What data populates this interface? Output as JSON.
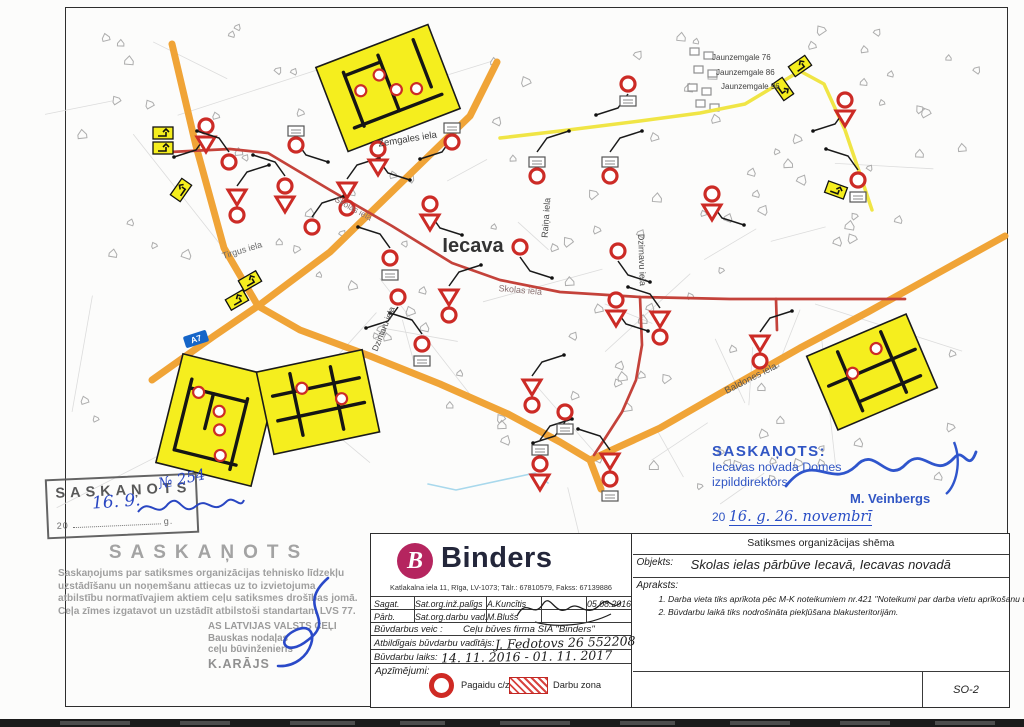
{
  "map": {
    "town_label": "Iecava",
    "route_shield": "A7",
    "colors": {
      "road_primary": "#F0A437",
      "detour_yellow": "#F0E545",
      "construction_red": "#C4423A",
      "sign_red": "#CC2B26",
      "inset_yellow": "#F5EE1E",
      "shield_blue": "#1565C8",
      "stamp_blue": "#3156C4",
      "ink_blue": "#2946C2",
      "stamp_gray": "#999999",
      "building_gray": "#ADADAD",
      "parcel_gray": "#DCDCDC",
      "stream_blue": "#A8D8EC"
    },
    "street_labels": [
      {
        "text": "Zemgales iela",
        "x": 408,
        "y": 142,
        "rot": -9,
        "size": 9.5,
        "color": "#3a3a3a"
      },
      {
        "text": "Tirgus iela",
        "x": 243,
        "y": 253,
        "rot": -17,
        "size": 9,
        "color": "#6b6b6b"
      },
      {
        "text": "Raiņa iela",
        "x": 549,
        "y": 218,
        "rot": -86,
        "size": 9,
        "color": "#4a4a4a"
      },
      {
        "text": "Dzirnavu iela",
        "x": 639,
        "y": 260,
        "rot": 88,
        "size": 9,
        "color": "#4a4a4a"
      },
      {
        "text": "Dzintaru iela",
        "x": 386,
        "y": 330,
        "rot": -68,
        "size": 8.5,
        "color": "#4a4a4a"
      },
      {
        "text": "Skolas iela",
        "x": 520,
        "y": 293,
        "rot": 5,
        "size": 9,
        "color": "#8a7272"
      },
      {
        "text": "Skolas iela",
        "x": 352,
        "y": 211,
        "rot": 29,
        "size": 8.5,
        "color": "#8a7272"
      },
      {
        "text": "Baldones iela",
        "x": 752,
        "y": 381,
        "rot": -27,
        "size": 9.5,
        "color": "#555555"
      }
    ],
    "address_labels": [
      {
        "text": "Jaunzemgale 76",
        "x": 712,
        "y": 60
      },
      {
        "text": "Jaunzemgale 86",
        "x": 716,
        "y": 75
      },
      {
        "text": "Jaunzemgale 96",
        "x": 721,
        "y": 89
      }
    ],
    "roads": [
      {
        "name": "regional-road-north",
        "kind": "primary",
        "w": 7,
        "pts": [
          [
            172,
            44
          ],
          [
            196,
            146
          ],
          [
            224,
            248
          ],
          [
            258,
            306
          ]
        ]
      },
      {
        "name": "a7-zemgales-diagonal",
        "kind": "primary",
        "w": 7,
        "pts": [
          [
            152,
            380
          ],
          [
            214,
            336
          ],
          [
            258,
            306
          ],
          [
            330,
            252
          ],
          [
            404,
            180
          ],
          [
            470,
            116
          ],
          [
            497,
            62
          ]
        ]
      },
      {
        "name": "road-to-south-junction",
        "kind": "primary",
        "w": 7,
        "pts": [
          [
            258,
            306
          ],
          [
            300,
            330
          ],
          [
            370,
            356
          ],
          [
            440,
            384
          ],
          [
            508,
            414
          ],
          [
            560,
            442
          ],
          [
            590,
            460
          ],
          [
            601,
            489
          ]
        ]
      },
      {
        "name": "baldones-diagonal",
        "kind": "primary",
        "w": 7,
        "pts": [
          [
            590,
            460
          ],
          [
            660,
            428
          ],
          [
            726,
            390
          ],
          [
            800,
            348
          ],
          [
            868,
            312
          ],
          [
            940,
            272
          ],
          [
            1005,
            236
          ]
        ]
      },
      {
        "name": "detour-route",
        "kind": "detour",
        "w": 3.5,
        "pts": [
          [
            500,
            138
          ],
          [
            560,
            131
          ],
          [
            640,
            121
          ],
          [
            700,
            113
          ],
          [
            745,
            104
          ],
          [
            800,
            71
          ],
          [
            824,
            84
          ],
          [
            845,
            130
          ],
          [
            862,
            180
          ],
          [
            872,
            210
          ]
        ]
      },
      {
        "name": "skolas-iela-construction",
        "kind": "construction",
        "w": 2.7,
        "pts": [
          [
            170,
            152
          ],
          [
            230,
            149
          ],
          [
            268,
            153
          ],
          [
            330,
            190
          ],
          [
            392,
            226
          ],
          [
            452,
            263
          ],
          [
            500,
            280
          ],
          [
            560,
            292
          ],
          [
            640,
            297
          ],
          [
            730,
            299
          ],
          [
            905,
            299
          ]
        ]
      },
      {
        "name": "construction-branch-south",
        "kind": "construction",
        "w": 2.7,
        "pts": [
          [
            640,
            297
          ],
          [
            642,
            345
          ],
          [
            636,
            380
          ],
          [
            622,
            412
          ],
          [
            604,
            440
          ],
          [
            594,
            455
          ]
        ]
      },
      {
        "name": "construction-stub",
        "kind": "construction",
        "w": 2.7,
        "pts": [
          [
            776,
            299
          ],
          [
            777,
            330
          ]
        ]
      },
      {
        "name": "stream",
        "kind": "stream",
        "w": 1.6,
        "pts": [
          [
            428,
            484
          ],
          [
            456,
            490
          ],
          [
            535,
            473
          ],
          [
            548,
            483
          ]
        ]
      }
    ],
    "shield": {
      "x": 196,
      "y": 339,
      "rot": -18
    },
    "signs": [
      {
        "x": 163,
        "y": 133,
        "t": [
          "yp",
          "yp"
        ]
      },
      {
        "x": 181,
        "y": 190,
        "t": [
          "yp"
        ],
        "r": -55
      },
      {
        "x": 206,
        "y": 126,
        "t": [
          "ring",
          "tri"
        ],
        "f": -1,
        "ly": 1
      },
      {
        "x": 229,
        "y": 162,
        "t": [
          "ring"
        ],
        "f": -1,
        "ly": -1
      },
      {
        "x": 237,
        "y": 196,
        "t": [
          "tri",
          "ring"
        ],
        "f": 1,
        "ly": -1
      },
      {
        "x": 285,
        "y": 186,
        "t": [
          "ring",
          "tri"
        ],
        "f": -1,
        "ly": -1
      },
      {
        "x": 296,
        "y": 131,
        "t": [
          "plate",
          "ring"
        ],
        "f": 1,
        "ly": 1
      },
      {
        "x": 312,
        "y": 227,
        "t": [
          "ring"
        ],
        "f": 1,
        "ly": -1
      },
      {
        "x": 347,
        "y": 189,
        "t": [
          "tri",
          "ring"
        ],
        "f": 1,
        "ly": -1
      },
      {
        "x": 378,
        "y": 149,
        "t": [
          "ring",
          "tri"
        ],
        "f": 1,
        "ly": 1
      },
      {
        "x": 390,
        "y": 258,
        "t": [
          "ring",
          "plate"
        ],
        "f": -1,
        "ly": -1
      },
      {
        "x": 430,
        "y": 204,
        "t": [
          "ring",
          "tri"
        ],
        "f": 1,
        "ly": 1
      },
      {
        "x": 398,
        "y": 297,
        "t": [
          "ring"
        ],
        "f": -1,
        "ly": 1
      },
      {
        "x": 422,
        "y": 344,
        "t": [
          "ring",
          "plate"
        ],
        "f": -1,
        "ly": -1
      },
      {
        "x": 452,
        "y": 128,
        "t": [
          "plate",
          "ring"
        ],
        "f": -1,
        "ly": 1
      },
      {
        "x": 449,
        "y": 296,
        "t": [
          "tri",
          "ring"
        ],
        "f": 1,
        "ly": -1
      },
      {
        "x": 537,
        "y": 162,
        "t": [
          "plate",
          "ring"
        ],
        "f": 1,
        "ly": -1
      },
      {
        "x": 610,
        "y": 162,
        "t": [
          "plate",
          "ring"
        ],
        "f": 1,
        "ly": -1
      },
      {
        "x": 520,
        "y": 247,
        "t": [
          "ring"
        ],
        "f": 1,
        "ly": 1
      },
      {
        "x": 532,
        "y": 386,
        "t": [
          "tri",
          "ring"
        ],
        "f": 1,
        "ly": -1
      },
      {
        "x": 618,
        "y": 251,
        "t": [
          "ring"
        ],
        "f": 1,
        "ly": 1
      },
      {
        "x": 616,
        "y": 300,
        "t": [
          "ring",
          "tri"
        ],
        "f": 1,
        "ly": 1
      },
      {
        "x": 660,
        "y": 318,
        "t": [
          "tri",
          "ring"
        ],
        "f": -1,
        "ly": -1
      },
      {
        "x": 712,
        "y": 194,
        "t": [
          "ring",
          "tri"
        ],
        "f": 1,
        "ly": 1
      },
      {
        "x": 760,
        "y": 342,
        "t": [
          "tri",
          "ring"
        ],
        "f": 1,
        "ly": -1
      },
      {
        "x": 628,
        "y": 84,
        "t": [
          "ring",
          "plate"
        ],
        "f": -1,
        "ly": 1
      },
      {
        "x": 845,
        "y": 100,
        "t": [
          "ring",
          "tri"
        ],
        "f": -1,
        "ly": 1
      },
      {
        "x": 858,
        "y": 180,
        "t": [
          "ring",
          "plate"
        ],
        "f": -1,
        "ly": -1
      },
      {
        "x": 836,
        "y": 190,
        "t": [
          "yp"
        ],
        "r": 20
      },
      {
        "x": 610,
        "y": 460,
        "t": [
          "tri",
          "ring",
          "plate"
        ],
        "f": -1,
        "ly": -1
      },
      {
        "x": 540,
        "y": 450,
        "t": [
          "plate",
          "ring",
          "tri"
        ],
        "f": 1,
        "ly": -1
      },
      {
        "x": 565,
        "y": 412,
        "t": [
          "ring",
          "plate"
        ],
        "f": -1,
        "ly": 1
      },
      {
        "x": 250,
        "y": 281,
        "t": [
          "yp"
        ],
        "r": -30
      },
      {
        "x": 237,
        "y": 300,
        "t": [
          "yp"
        ],
        "r": -30
      },
      {
        "x": 800,
        "y": 66,
        "t": [
          "yp"
        ],
        "r": -35
      },
      {
        "x": 783,
        "y": 89,
        "t": [
          "yp"
        ],
        "r": 55
      }
    ],
    "insets": [
      {
        "cx": 388,
        "cy": 88,
        "w": 120,
        "h": 90,
        "rot": -21,
        "circles": [
          [
            0.28,
            0.42
          ],
          [
            0.47,
            0.33
          ],
          [
            0.56,
            0.55
          ],
          [
            0.72,
            0.62
          ]
        ],
        "lines": [
          [
            0.12,
            0.78,
            0.9,
            0.78
          ],
          [
            0.2,
            0.16,
            0.2,
            0.8
          ],
          [
            0.52,
            0.12,
            0.52,
            0.78
          ],
          [
            0.84,
            0.1,
            0.84,
            0.66
          ],
          [
            0.2,
            0.2,
            0.52,
            0.2
          ]
        ]
      },
      {
        "cx": 217,
        "cy": 420,
        "w": 98,
        "h": 112,
        "rot": 14,
        "circles": [
          [
            0.25,
            0.3
          ],
          [
            0.5,
            0.42
          ],
          [
            0.55,
            0.58
          ],
          [
            0.62,
            0.8
          ]
        ],
        "lines": [
          [
            0.15,
            0.2,
            0.15,
            0.85
          ],
          [
            0.15,
            0.28,
            0.75,
            0.28
          ],
          [
            0.75,
            0.25,
            0.75,
            0.9
          ],
          [
            0.4,
            0.28,
            0.4,
            0.6
          ],
          [
            0.15,
            0.85,
            0.8,
            0.85
          ]
        ]
      },
      {
        "cx": 318,
        "cy": 402,
        "w": 108,
        "h": 84,
        "rot": -12,
        "circles": [
          [
            0.38,
            0.3
          ],
          [
            0.72,
            0.52
          ]
        ],
        "lines": [
          [
            0.1,
            0.32,
            0.92,
            0.32
          ],
          [
            0.1,
            0.62,
            0.92,
            0.62
          ],
          [
            0.3,
            0.1,
            0.3,
            0.85
          ],
          [
            0.68,
            0.12,
            0.68,
            0.88
          ]
        ]
      },
      {
        "cx": 872,
        "cy": 372,
        "w": 108,
        "h": 80,
        "rot": -23,
        "circles": [
          [
            0.33,
            0.42
          ],
          [
            0.62,
            0.25
          ]
        ],
        "lines": [
          [
            0.08,
            0.45,
            0.95,
            0.45
          ],
          [
            0.28,
            0.1,
            0.28,
            0.9
          ],
          [
            0.72,
            0.08,
            0.72,
            0.9
          ],
          [
            0.3,
            0.78,
            0.9,
            0.78
          ]
        ]
      }
    ]
  },
  "stamps": {
    "left_box": {
      "title": "SASKAŅOTS",
      "date_prefix": "20",
      "date_suffix": "g.",
      "hand_number": "№ 254",
      "hand_date": "16. 9."
    },
    "agreement": {
      "title": "SASKAŅOTS",
      "body": [
        "Saskaņojums par satiksmes organizācijas tehnisko līdzekļu",
        "uzstādīšanu un noņemšanu attiecas uz to izvietojuma",
        "atbilstību normatīvajiem aktiem ceļu satiksmes drošības jomā.",
        "Ceļa zīmes izgatavot un uzstādīt atbilstoši standartam LVS 77."
      ],
      "org_lines": [
        "AS LATVIJAS VALSTS CEĻI",
        "Bauskas nodaļas",
        "ceļu būvinženieris"
      ],
      "signer": "K.ARĀJS"
    },
    "right": {
      "title": "SASKAŅOTS:",
      "line1": "Iecavas novada Domes",
      "line2": "izpilddirektors",
      "signer": "M. Veinbergs",
      "date_prefix": "20",
      "hand_date": "16. g. 26. novembrī"
    }
  },
  "title_block": {
    "left": {
      "logo_letter": "B",
      "company": "Binders",
      "address": "Katlakalna iela 11, Rīga, LV-1073; Tālr.: 67810579, Fakss: 67139886",
      "rows": [
        {
          "col1": "Sagat.",
          "col2": "Sat.org.inž.palīgs",
          "col3": "A.Kuncītis",
          "date": "05.08.2016"
        },
        {
          "col1": "Pārb.",
          "col2": "Sat.org.darbu vad.",
          "col3": "M.Blušs",
          "date": ""
        }
      ],
      "performer_label": "Būvdarbus veic :",
      "performer_value": "Ceļu būves firma SIA \"Binders\"",
      "responsible_label": "Atbildīgais būvdarbu vadītājs:",
      "responsible_value": "J. Fedotovs 26 552208",
      "period_label": "Būvdarbu laiks:",
      "period_value": "14. 11. 2016  -  01. 11. 2017",
      "legend_label": "Apzīmējumi:",
      "legend_items": [
        {
          "symbol": "temporary-sign-ring",
          "label": "Pagaidu c/z"
        },
        {
          "symbol": "work-zone-hatch",
          "label": "Darbu zona"
        }
      ]
    },
    "right": {
      "header": "Satiksmes organizācijas shēma",
      "object_label": "Objekts:",
      "object_value": "Skolas ielas pārbūve Iecavā, Iecavas novadā",
      "description_label": "Apraksts:",
      "description_items": [
        "1. Darba vieta tiks aprīkota pēc M-K noteikumiem nr.421 \"Noteikumi par darba vietu aprīkošanu uz ceļiem\".",
        "2. Būvdarbu laikā tiks nodrošināta piekļūšana blakusteritorijām."
      ],
      "sheet_number": "SO-2"
    }
  }
}
